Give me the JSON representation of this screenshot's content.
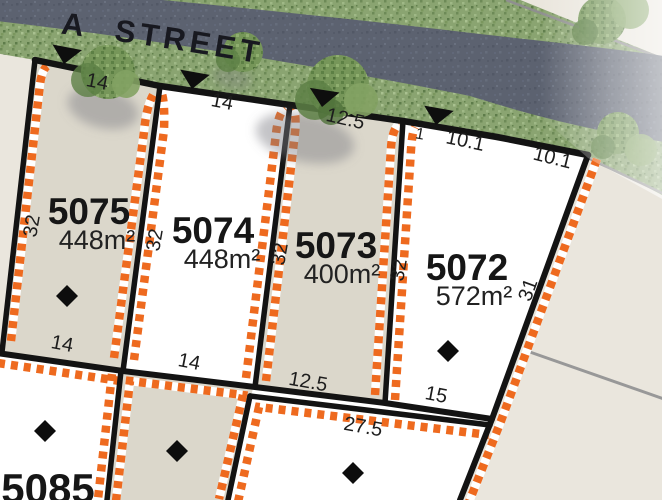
{
  "street": {
    "name": "NARKOOLA STREET"
  },
  "lots": [
    {
      "number": "5075",
      "area": "448m²",
      "fill": "beige",
      "frontage": "14",
      "side": "32",
      "rear": "14",
      "has_access_arrow": true,
      "has_diamond_marker": true
    },
    {
      "number": "5074",
      "area": "448m²",
      "fill": "white",
      "frontage": "14",
      "side": "32",
      "rear": "14",
      "has_access_arrow": true,
      "has_diamond_marker": false
    },
    {
      "number": "5073",
      "area": "400m²",
      "fill": "beige",
      "frontage": "12.5",
      "side": "32",
      "rear": "12.5",
      "has_access_arrow": true,
      "has_diamond_marker": false
    },
    {
      "number": "5072",
      "area": "572m²",
      "fill": "white",
      "frontage_segments": [
        "1",
        "10.1",
        "10.1"
      ],
      "side_left": "32",
      "side_right": "31",
      "rear": "15",
      "has_access_arrow": true,
      "has_diamond_marker": true
    },
    {
      "number": "5085",
      "area": "",
      "fill": "white",
      "has_diamond_marker": true
    }
  ],
  "dimension_labels": [
    {
      "value": "14",
      "lot": "5075",
      "edge": "front"
    },
    {
      "value": "14",
      "lot": "5074",
      "edge": "front"
    },
    {
      "value": "12.5",
      "lot": "5073",
      "edge": "front"
    },
    {
      "value": "1",
      "lot": "5072",
      "edge": "front"
    },
    {
      "value": "10.1",
      "lot": "5072",
      "edge": "front"
    },
    {
      "value": "10.1",
      "lot": "5072",
      "edge": "front"
    },
    {
      "value": "32",
      "lot": "5075",
      "edge": "side-left"
    },
    {
      "value": "32",
      "lot": "5074",
      "edge": "side-left"
    },
    {
      "value": "32",
      "lot": "5073",
      "edge": "side-left"
    },
    {
      "value": "32",
      "lot": "5072",
      "edge": "side-left"
    },
    {
      "value": "31",
      "lot": "5072",
      "edge": "side-right"
    },
    {
      "value": "14",
      "lot": "5075",
      "edge": "rear"
    },
    {
      "value": "14",
      "lot": "5074",
      "edge": "rear"
    },
    {
      "value": "12.5",
      "lot": "5073",
      "edge": "rear"
    },
    {
      "value": "15",
      "lot": "5072",
      "edge": "rear"
    },
    {
      "value": "27.5",
      "lot": "south-adjacent",
      "edge": "front"
    }
  ],
  "icons": {
    "street_access_arrow": "▼",
    "easement_marker": "◆"
  },
  "colors": {
    "background": "#eae6dd",
    "lot_fill_beige": "#dbd7cb",
    "lot_fill_white": "#ffffff",
    "boundary_black": "#131313",
    "envelope_orange": "#ee6a1f",
    "road_gray": "#5c6270",
    "verge_green": "#8aa471",
    "future_line_gray": "#8f8f8f"
  }
}
